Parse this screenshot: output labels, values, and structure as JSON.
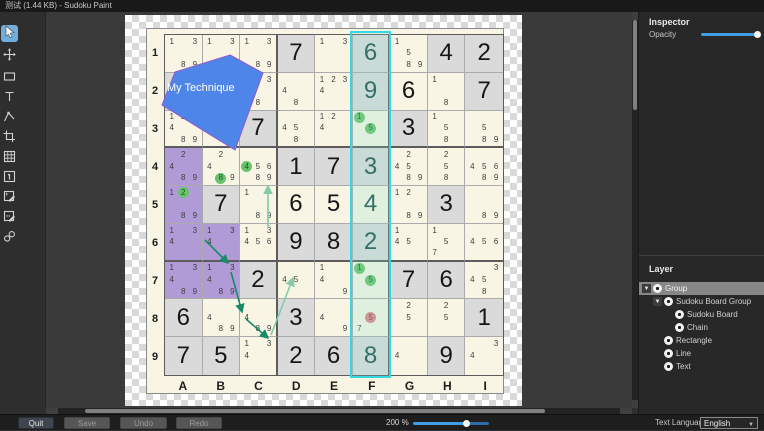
{
  "title_bar": {
    "title": "测试 (1.44 KB) - Sudoku Paint"
  },
  "toolbar": {
    "selected_tool": "select-tool",
    "tools": [
      "select-tool",
      "move-tool",
      "rectangle-tool",
      "text-tool",
      "polygon-tool",
      "crop-tool",
      "grid-tool",
      "big-number-tool",
      "corner-mark-tool",
      "center-mark-tool",
      "link-tool"
    ]
  },
  "inspector": {
    "header": "Inspector",
    "opacity_label": "Opacity",
    "opacity_percent": 100
  },
  "layers": {
    "header": "Layer",
    "tree": [
      {
        "label": "Group",
        "depth": 0,
        "toggle": true,
        "selected": true
      },
      {
        "label": "Sudoku Board Group",
        "depth": 1,
        "toggle": true,
        "selected": false
      },
      {
        "label": "Sudoku Board",
        "depth": 2,
        "toggle": false,
        "selected": false
      },
      {
        "label": "Chain",
        "depth": 2,
        "toggle": false,
        "selected": false
      },
      {
        "label": "Rectangle",
        "depth": 1,
        "toggle": false,
        "selected": false
      },
      {
        "label": "Line",
        "depth": 1,
        "toggle": false,
        "selected": false
      },
      {
        "label": "Text",
        "depth": 1,
        "toggle": false,
        "selected": false
      }
    ]
  },
  "bottom_bar": {
    "quit_label": "Quit",
    "save_label": "Save",
    "undo_label": "Undo",
    "redo_label": "Redo",
    "zoom_label": "200 %",
    "zoom_percent": 200,
    "language_label": "Text Language",
    "language_value": "English"
  },
  "board": {
    "row_labels": [
      "1",
      "2",
      "3",
      "4",
      "5",
      "6",
      "7",
      "8",
      "9"
    ],
    "col_labels": [
      "A",
      "B",
      "C",
      "D",
      "E",
      "F",
      "G",
      "H",
      "I"
    ],
    "highlight_column": "F",
    "cells": [
      [
        {
          "m": [
            1,
            3,
            8,
            9
          ]
        },
        {
          "m": [
            1,
            3,
            8,
            9
          ]
        },
        {
          "m": [
            1,
            3,
            8,
            9
          ]
        },
        {
          "bg": "g",
          "b": 7
        },
        {
          "m": [
            1,
            3
          ]
        },
        {
          "bg": "g",
          "b": 6
        },
        {
          "m": [
            1,
            5,
            8,
            9
          ]
        },
        {
          "bg": "g",
          "b": 4
        },
        {
          "bg": "g",
          "b": 2
        }
      ],
      [
        {
          "bg": "g"
        },
        {},
        {
          "m": [
            3,
            8
          ]
        },
        {
          "m": [
            4,
            8
          ]
        },
        {
          "m": [
            1,
            2,
            3,
            4
          ]
        },
        {
          "bg": "g",
          "b": 9
        },
        {
          "b": 6
        },
        {
          "m": [
            1,
            8
          ]
        },
        {
          "bg": "g",
          "b": 7
        }
      ],
      [
        {
          "m": [
            1,
            2,
            4,
            8,
            9
          ]
        },
        {},
        {
          "bg": "g",
          "b": 7
        },
        {
          "m": [
            4,
            5,
            8
          ]
        },
        {
          "m": [
            1,
            2,
            4
          ]
        },
        {
          "m": [
            1,
            5
          ],
          "circ": {
            "1": "g",
            "5": "g"
          }
        },
        {
          "bg": "g",
          "b": 3
        },
        {
          "m": [
            1,
            5,
            8
          ]
        },
        {
          "m": [
            5,
            8,
            9
          ]
        }
      ],
      [
        {
          "bg": "p",
          "m": [
            2,
            4,
            8,
            9
          ]
        },
        {
          "m": [
            2,
            4,
            8,
            9
          ],
          "circ": {
            "8": "g"
          }
        },
        {
          "m": [
            4,
            5,
            6,
            8,
            9
          ],
          "circ": {
            "4": "g"
          }
        },
        {
          "bg": "g",
          "b": 1
        },
        {
          "bg": "g",
          "b": 7
        },
        {
          "bg": "g",
          "b": 3
        },
        {
          "m": [
            2,
            4,
            5,
            8,
            9
          ]
        },
        {
          "m": [
            2,
            5,
            8
          ]
        },
        {
          "m": [
            4,
            5,
            6,
            8,
            9
          ]
        }
      ],
      [
        {
          "bg": "p",
          "m": [
            1,
            2,
            8,
            9
          ],
          "circ": {
            "2": "g"
          }
        },
        {
          "bg": "g",
          "b": 7
        },
        {
          "m": [
            1,
            8,
            9
          ]
        },
        {
          "b": 6
        },
        {
          "b": 5
        },
        {
          "b": 4
        },
        {
          "m": [
            1,
            2,
            8,
            9
          ]
        },
        {
          "bg": "g",
          "b": 3
        },
        {
          "m": [
            8,
            9
          ]
        }
      ],
      [
        {
          "bg": "p",
          "m": [
            1,
            3,
            4
          ]
        },
        {
          "bg": "p",
          "m": [
            1,
            3,
            4
          ]
        },
        {
          "m": [
            1,
            3,
            4,
            5,
            6
          ]
        },
        {
          "bg": "g",
          "b": 9
        },
        {
          "bg": "g",
          "b": 8
        },
        {
          "bg": "g",
          "b": 2
        },
        {
          "m": [
            1,
            4,
            5
          ]
        },
        {
          "m": [
            1,
            5,
            7
          ]
        },
        {
          "m": [
            4,
            5,
            6
          ]
        }
      ],
      [
        {
          "bg": "p",
          "m": [
            1,
            3,
            4,
            8,
            9
          ]
        },
        {
          "bg": "p",
          "m": [
            1,
            3,
            4,
            8,
            9
          ]
        },
        {
          "bg": "g",
          "b": 2
        },
        {
          "m": [
            4,
            5
          ]
        },
        {
          "m": [
            1,
            4,
            9
          ]
        },
        {
          "m": [
            1,
            5
          ],
          "circ": {
            "1": "g",
            "5": "g"
          }
        },
        {
          "bg": "g",
          "b": 7
        },
        {
          "bg": "g",
          "b": 6
        },
        {
          "m": [
            3,
            4,
            5,
            8
          ]
        }
      ],
      [
        {
          "bg": "g",
          "b": 6
        },
        {
          "m": [
            4,
            8,
            9
          ]
        },
        {
          "m": [
            4,
            8,
            9
          ]
        },
        {
          "bg": "g",
          "b": 3
        },
        {
          "m": [
            4,
            9
          ]
        },
        {
          "m": [
            5,
            7
          ],
          "circ": {
            "5": "r"
          }
        },
        {
          "m": [
            2,
            5
          ]
        },
        {
          "m": [
            2,
            5
          ]
        },
        {
          "bg": "g",
          "b": 1
        }
      ],
      [
        {
          "bg": "g",
          "b": 7
        },
        {
          "bg": "g",
          "b": 5
        },
        {
          "m": [
            1,
            3,
            4
          ]
        },
        {
          "bg": "g",
          "b": 2
        },
        {
          "bg": "g",
          "b": 6
        },
        {
          "bg": "g",
          "b": 8
        },
        {
          "m": [
            4
          ]
        },
        {
          "bg": "g",
          "b": 9
        },
        {
          "m": [
            3,
            4
          ]
        }
      ]
    ]
  },
  "annotations": {
    "rect": {
      "x": 304,
      "y": 19,
      "w": 41,
      "h": 347,
      "stroke": "#35d8e2"
    },
    "polygon": {
      "points": "184,43 217,61 189,138 116,93 129,60",
      "fill": "#4d86e8",
      "stroke": "#9657c8",
      "label": "My Technique",
      "label_x": 168,
      "label_y": 79,
      "label_color": "#ffffff"
    },
    "chains": [
      {
        "x1": 159,
        "y1": 228,
        "x2": 182,
        "y2": 251,
        "tone": "dark"
      },
      {
        "x1": 185,
        "y1": 260,
        "x2": 196,
        "y2": 300,
        "tone": "dark"
      },
      {
        "x1": 200,
        "y1": 307,
        "x2": 222,
        "y2": 326,
        "tone": "dark"
      },
      {
        "x1": 225,
        "y1": 323,
        "x2": 247,
        "y2": 266,
        "tone": "light"
      },
      {
        "x1": 222,
        "y1": 216,
        "x2": 222,
        "y2": 174,
        "tone": "light"
      }
    ],
    "chain_colors": {
      "dark": "#178a68",
      "light": "#85caa8"
    }
  },
  "colors": {
    "cell_cream": "#f8f5e4",
    "cell_grey": "#dadada",
    "cell_purple": "#b09bd6",
    "circle_green": "#68c36d",
    "circle_red": "#e1848d",
    "accent_blue": "#3f9ee6",
    "rect_cyan": "#35d8e2"
  }
}
